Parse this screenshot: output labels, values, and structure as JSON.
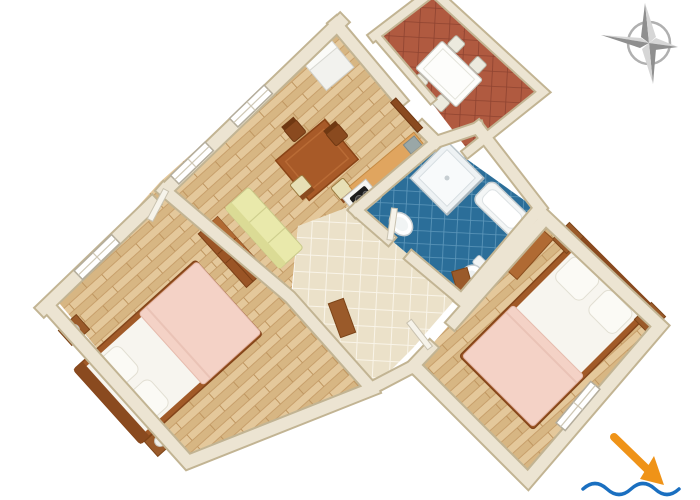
{
  "figure": {
    "type": "3D apartment floor plan, bird's-eye view",
    "aria_label": "3D rendered floor plan of an apartment with a living and dining room, kitchen corner, bathroom, hallway, two bedrooms and a tiled terrace; a compass rose sits top-right and an orange arrow pointing to blue waves (sea direction) sits bottom-right"
  },
  "rooms": [
    {
      "id": "living-dining",
      "label": "Living / dining room",
      "floor": "light wood parquet",
      "floor_color": "#dfc193",
      "furniture": [
        "dining table",
        "2 dark wood chairs",
        "2 cream seat chairs",
        "sofa bed",
        "refrigerator",
        "door to terrace"
      ]
    },
    {
      "id": "kitchen",
      "label": "Kitchen corner",
      "floor": "cream tiles",
      "floor_color": "#ebe1c9",
      "furniture": [
        "kitchen counter",
        "stove with two burners",
        "dish rack"
      ]
    },
    {
      "id": "hallway",
      "label": "Hallway",
      "floor": "cream tiles",
      "floor_color": "#ebe1c9",
      "furniture": []
    },
    {
      "id": "bathroom",
      "label": "Bathroom",
      "floor": "blue tiles",
      "floor_color": "#2b6e99",
      "furniture": [
        "shower cabin",
        "bathtub",
        "washbasin",
        "toilet"
      ]
    },
    {
      "id": "bedroom-left",
      "label": "Bedroom (left)",
      "floor": "light wood parquet",
      "floor_color": "#dfc193",
      "furniture": [
        "double bed with pink blanket",
        "2 nightstands with lamps",
        "chest of drawers",
        "desk"
      ]
    },
    {
      "id": "bedroom-right",
      "label": "Bedroom (right)",
      "floor": "light wood parquet",
      "floor_color": "#dfc193",
      "furniture": [
        "double bed with pink blanket",
        "2 nightstands with lamps",
        "dresser",
        "bench",
        "window"
      ]
    },
    {
      "id": "terrace",
      "label": "Terrace",
      "floor": "terracotta tiles",
      "floor_color": "#b05a40",
      "furniture": [
        "white outdoor table",
        "4 white chairs"
      ]
    }
  ],
  "annotations": {
    "compass_rose": {
      "icon": "compass-rose",
      "color": "#a9a9a9",
      "position": "top-right"
    },
    "sea_direction": {
      "icon": "arrow-to-waves",
      "arrow_color": "#ef9318",
      "waves_color": "#1a6fc0",
      "position": "bottom-right"
    }
  },
  "palette": {
    "background": "#ffffff",
    "walls": "#ece4d2",
    "wall_edge": "#c2b493",
    "wood_furniture": "#9a5a2a",
    "bed_frame": "#a15a28",
    "bed_blanket": "#f4d2c6",
    "mattress": "#f7f5ef",
    "sofa": "#e9e9ab",
    "counter_top": "#e0a55f"
  }
}
